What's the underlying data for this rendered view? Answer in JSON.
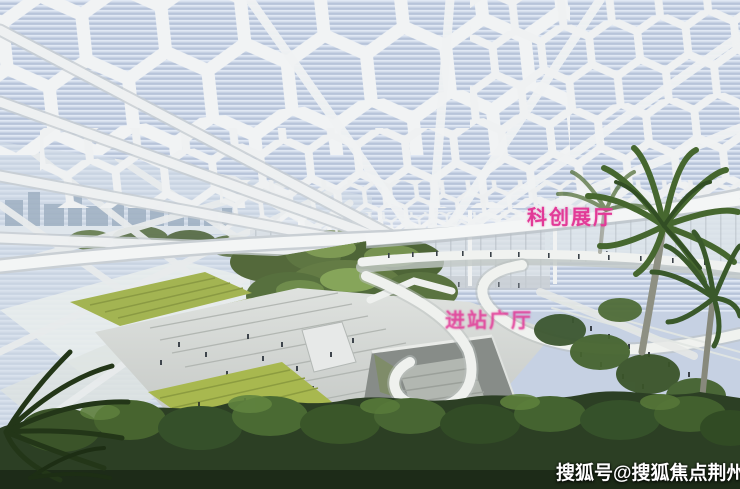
{
  "image": {
    "labels": [
      {
        "text": "科创展厅",
        "color": "#e23a97"
      },
      {
        "text": "进站广厅",
        "color": "#e23a97"
      }
    ],
    "watermark": {
      "text": "搜狐号@搜狐焦点荆州站",
      "color": "#ffffff"
    }
  }
}
